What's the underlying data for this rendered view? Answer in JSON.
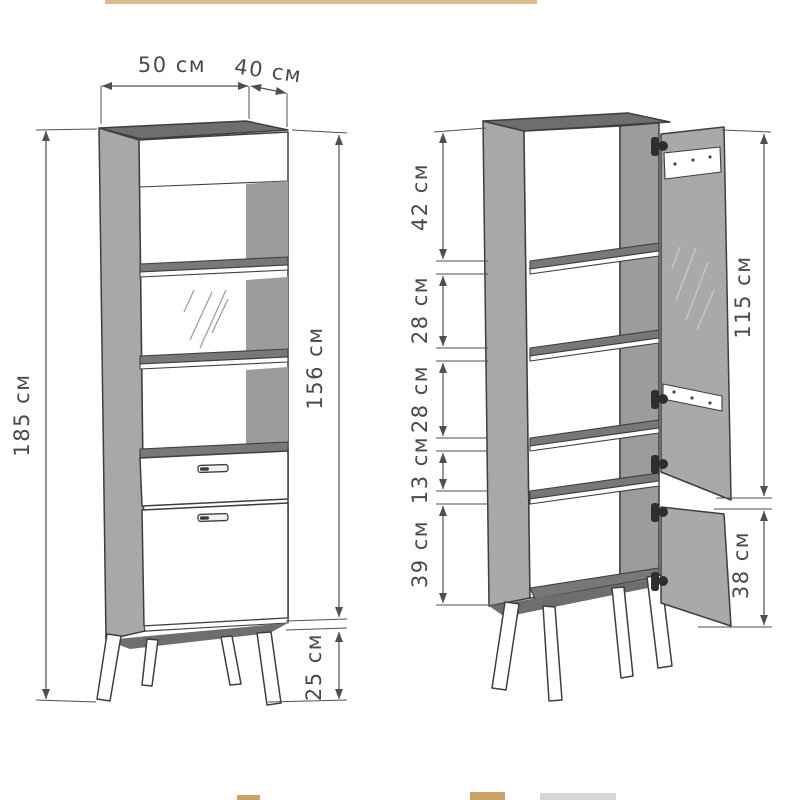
{
  "drawing": {
    "views": {
      "closed": {
        "label": "closed-cabinet-front-view",
        "dims": {
          "top_width": "50 см",
          "top_depth": "40 см",
          "overall_height": "185 см",
          "carcass_height": "156 см",
          "legs_height": "25 см"
        }
      },
      "open": {
        "label": "open-cabinet-view",
        "shelf_dims": [
          "42 см",
          "28 см",
          "28 см",
          "13 см",
          "39 см"
        ],
        "glass_door_height": "115 см",
        "lower_door_height": "38 см"
      }
    },
    "dimension_values_cm": {
      "width": 50,
      "depth": 40,
      "overall_height": 185,
      "carcass_height": 156,
      "legs_height": 25,
      "shelf_spacings": [
        42,
        28,
        28,
        13,
        39
      ],
      "glass_door": 115,
      "lower_door": 38
    }
  },
  "colors": {
    "background": "#ffffff",
    "line": "#3e3e3e",
    "dim": "#4f4f4f",
    "text": "#4a4a4a",
    "panel": "#a8a8a8",
    "panel_dark": "#6e6e6e",
    "shelf_dark": "#787878",
    "inner": "#9c9c9c",
    "door": "#a9a9a9",
    "top_strip": "#dcb98e",
    "bottom_tan": "#c9a267",
    "bottom_gray": "#d6d6d4"
  }
}
